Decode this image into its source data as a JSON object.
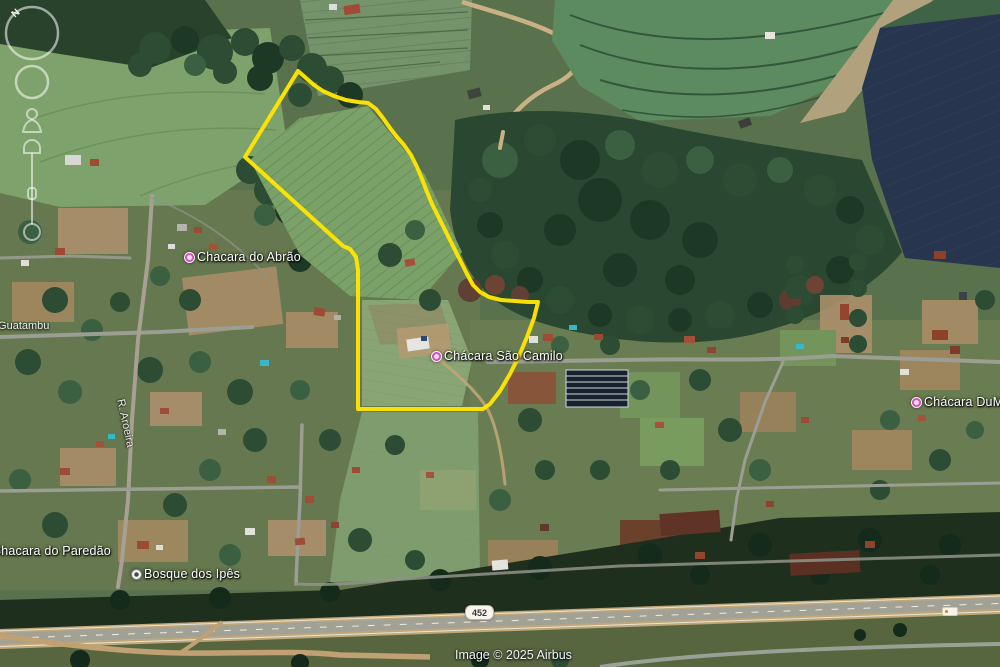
{
  "places": [
    {
      "id": "abrao",
      "label": "Chacara do Abrão"
    },
    {
      "id": "sao-camilo",
      "label": "Chácara São Camilo"
    },
    {
      "id": "dumat",
      "label": "Chácara DuMat"
    },
    {
      "id": "paredao",
      "label": "Chacara do Paredão"
    },
    {
      "id": "bosque",
      "label": "Bosque dos Ipês"
    }
  ],
  "roads": {
    "guatambu": "R. Guatambu",
    "aroeira": "R. Aroeira",
    "shield": "452"
  },
  "attribution": "Image © 2025 Airbus",
  "compass": {
    "north": "N"
  },
  "boundary": {
    "color": "#ffe600",
    "points": "298,71 306,78 314,85 323,91 334,96 346,100 358,102 368,103 376,109 383,118 390,128 397,137 404,145 411,155 417,167 422,179 427,192 432,204 439,218 446,232 453,246 460,260 467,274 473,285 480,292 489,297 501,300 515,301 528,302 538,302 534,318 527,337 519,356 510,374 500,391 490,404 483,409 358,409 358,270 356,257 350,249 343,246 245,157 298,71"
  },
  "pin_colors": {
    "place": "#d94fc4",
    "poi": "#f4f4f2"
  }
}
